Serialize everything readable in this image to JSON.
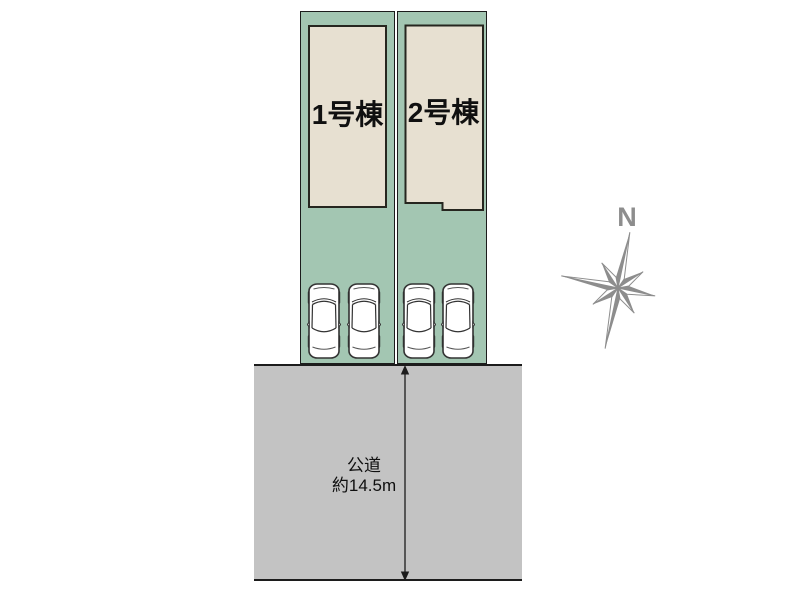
{
  "colors": {
    "lot_green": "#a3c6b2",
    "building_beige": "#e7e0d1",
    "road_gray": "#c3c3c3",
    "line_dark": "#1c1c1c",
    "bldg_line": "#26261f",
    "compass_gray": "#8d8d8d",
    "text_dark": "#0f0f0f"
  },
  "site_plan": {
    "buildings": [
      {
        "label": "1号棟"
      },
      {
        "label": "2号棟"
      }
    ],
    "road": {
      "name": "公道",
      "width_note": "約14.5m"
    },
    "compass": {
      "north_label": "N"
    },
    "parking": {
      "car_count": 4
    }
  }
}
